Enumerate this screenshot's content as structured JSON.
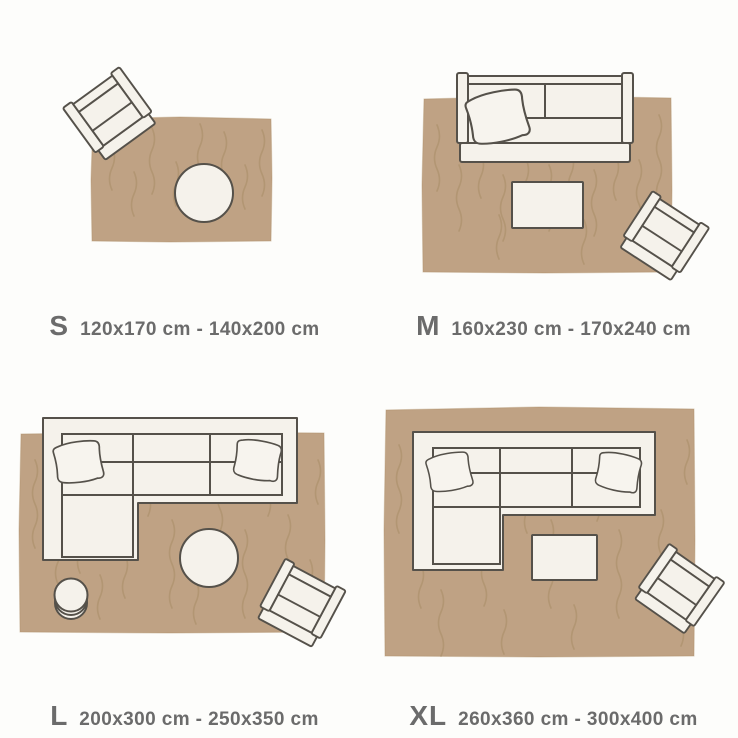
{
  "palette": {
    "background": "#fdfdfb",
    "rug": "#bfa284",
    "rug_edge": "#ab8c63",
    "rug_texture": "#a2875f",
    "furniture_fill": "#f5f2eb",
    "pillow_fill": "#f7f4ee",
    "furniture_outline": "#55514a",
    "label_color": "#6b6b6b"
  },
  "sizes": [
    {
      "letter": "S",
      "range": "120x170 cm - 140x200 cm"
    },
    {
      "letter": "M",
      "range": "160x230 cm - 170x240 cm"
    },
    {
      "letter": "L",
      "range": "200x300 cm - 250x350 cm"
    },
    {
      "letter": "XL",
      "range": "260x360 cm - 300x400 cm"
    }
  ]
}
